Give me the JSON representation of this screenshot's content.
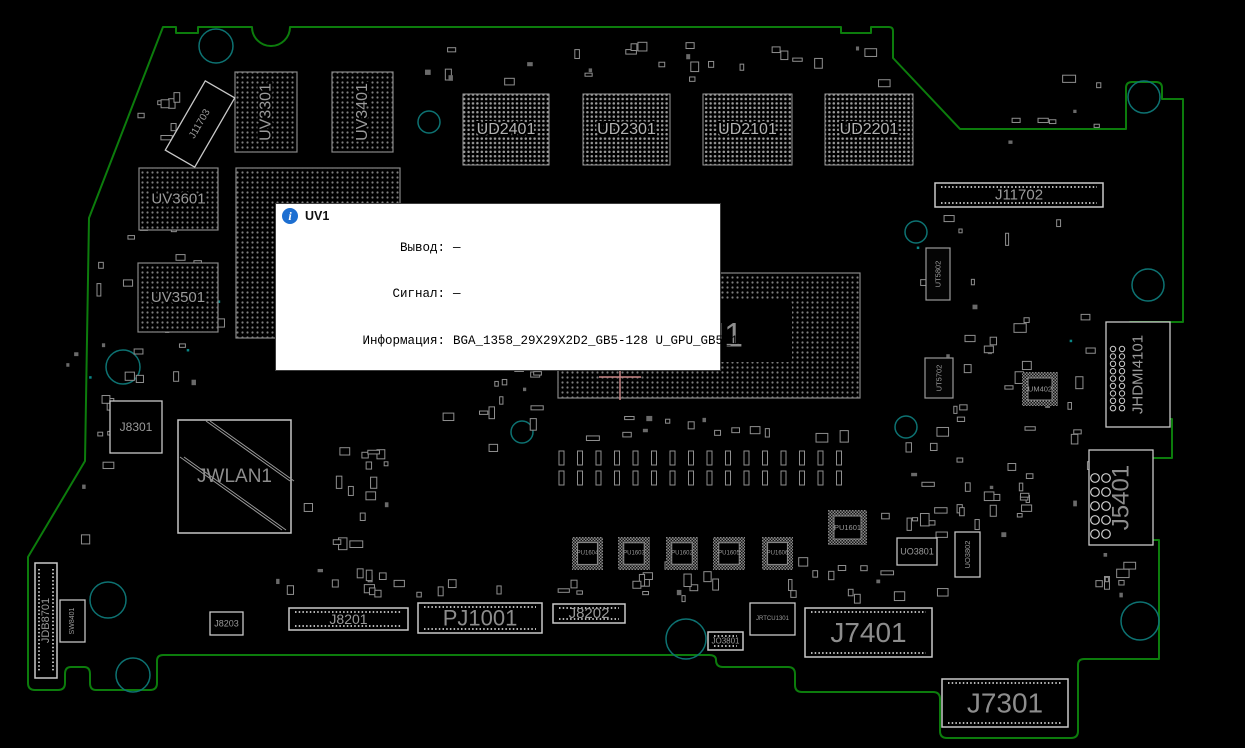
{
  "colors": {
    "background": "#000000",
    "outline": "#0c7c0c",
    "hole": "#0d7272",
    "component": "#9a9a9a",
    "connector": "#c9c9c9",
    "label": "#9a9a9a",
    "bga_label": "#b2b2b2",
    "big_label": "#8d8d8d",
    "crosshair": "#c98585",
    "via": "#0a8585",
    "info_icon": "#1d6fd1"
  },
  "tooltip": {
    "icon": "info-icon",
    "title": "UV1",
    "rows": [
      {
        "label": "Вывод:",
        "value": "—"
      },
      {
        "label": "Сигнал:",
        "value": "—"
      },
      {
        "label": "Информация:",
        "value": "BGA_1358_29X29X2D2_GB5-128 U_GPU_GB5_128"
      }
    ]
  },
  "board": {
    "holes": [
      {
        "cx": 216,
        "cy": 46,
        "r": 17
      },
      {
        "cx": 429,
        "cy": 122,
        "r": 11
      },
      {
        "cx": 916,
        "cy": 232,
        "r": 11
      },
      {
        "cx": 1144,
        "cy": 97,
        "r": 16
      },
      {
        "cx": 1148,
        "cy": 285,
        "r": 16
      },
      {
        "cx": 123,
        "cy": 367,
        "r": 17
      },
      {
        "cx": 522,
        "cy": 432,
        "r": 11
      },
      {
        "cx": 906,
        "cy": 427,
        "r": 11
      },
      {
        "cx": 108,
        "cy": 600,
        "r": 18
      },
      {
        "cx": 133,
        "cy": 675,
        "r": 17
      },
      {
        "cx": 686,
        "cy": 639,
        "r": 20
      },
      {
        "cx": 1140,
        "cy": 621,
        "r": 19
      }
    ],
    "components": [
      {
        "id": "uv3301",
        "label": "UV3301",
        "x": 235,
        "y": 72,
        "w": 62,
        "h": 80,
        "kind": "bga",
        "rot": -90,
        "fs": 16
      },
      {
        "id": "uv3401",
        "label": "UV3401",
        "x": 332,
        "y": 72,
        "w": 61,
        "h": 80,
        "kind": "bga",
        "rot": -90,
        "fs": 16
      },
      {
        "id": "ud2401",
        "label": "UD2401",
        "x": 463,
        "y": 94,
        "w": 86,
        "h": 71,
        "kind": "bga2",
        "fs": 16
      },
      {
        "id": "ud2301",
        "label": "UD2301",
        "x": 583,
        "y": 94,
        "w": 87,
        "h": 71,
        "kind": "bga2",
        "fs": 16
      },
      {
        "id": "ud2101",
        "label": "UD2101",
        "x": 703,
        "y": 94,
        "w": 89,
        "h": 71,
        "kind": "bga2",
        "fs": 16
      },
      {
        "id": "ud2201",
        "label": "UD2201",
        "x": 825,
        "y": 94,
        "w": 88,
        "h": 71,
        "kind": "bga2",
        "fs": 16
      },
      {
        "id": "uv3601",
        "label": "UV3601",
        "x": 139,
        "y": 168,
        "w": 79,
        "h": 62,
        "kind": "bga",
        "fs": 15
      },
      {
        "id": "uv3501",
        "label": "UV3501",
        "x": 138,
        "y": 263,
        "w": 80,
        "h": 69,
        "kind": "bga",
        "fs": 15
      },
      {
        "id": "uv1",
        "label": "",
        "x": 236,
        "y": 168,
        "w": 164,
        "h": 170,
        "kind": "bga"
      },
      {
        "id": "uu1",
        "label": "UU1",
        "x": 558,
        "y": 273,
        "w": 302,
        "h": 125,
        "kind": "bgaL",
        "fs": 34
      },
      {
        "id": "j11702",
        "label": "J11702",
        "x": 935,
        "y": 183,
        "w": 168,
        "h": 24,
        "kind": "conn",
        "fs": 15
      },
      {
        "id": "j11703",
        "label": "J11703",
        "x": 183,
        "y": 84,
        "w": 34,
        "h": 80,
        "kind": "connP",
        "grot": 30,
        "rot": -90,
        "fs": 10
      },
      {
        "id": "jhdmi4101",
        "label": "JHDMI4101",
        "x": 1106,
        "y": 322,
        "w": 64,
        "h": 105,
        "kind": "connP",
        "rot": -90,
        "fs": 15,
        "pins": "circles"
      },
      {
        "id": "j5401",
        "label": "J5401",
        "x": 1089,
        "y": 450,
        "w": 64,
        "h": 95,
        "kind": "connP",
        "rot": -90,
        "fs": 24,
        "pins": "circles"
      },
      {
        "id": "j8301",
        "label": "J8301",
        "x": 110,
        "y": 401,
        "w": 52,
        "h": 52,
        "kind": "connP",
        "fs": 12
      },
      {
        "id": "jwlan1",
        "label": "JWLAN1",
        "x": 178,
        "y": 420,
        "w": 113,
        "h": 113,
        "kind": "slot",
        "fs": 19
      },
      {
        "id": "jdb8701",
        "label": "JDB8701",
        "x": 35,
        "y": 563,
        "w": 22,
        "h": 115,
        "kind": "conn",
        "rot": -90,
        "fs": 11
      },
      {
        "id": "sw8401",
        "label": "SW8401",
        "x": 60,
        "y": 600,
        "w": 25,
        "h": 42,
        "kind": "chipL",
        "rot": -90,
        "fs": 7
      },
      {
        "id": "j8203",
        "label": "J8203",
        "x": 210,
        "y": 612,
        "w": 33,
        "h": 23,
        "kind": "connP",
        "fs": 9
      },
      {
        "id": "j8201",
        "label": "J8201",
        "x": 289,
        "y": 608,
        "w": 119,
        "h": 22,
        "kind": "conn",
        "fs": 14
      },
      {
        "id": "pj1001",
        "label": "PJ1001",
        "x": 418,
        "y": 603,
        "w": 124,
        "h": 30,
        "kind": "conn",
        "fs": 22
      },
      {
        "id": "j8202",
        "label": "J8202",
        "x": 553,
        "y": 604,
        "w": 72,
        "h": 19,
        "kind": "conn",
        "fs": 15
      },
      {
        "id": "jo3801",
        "label": "JO3801",
        "x": 708,
        "y": 632,
        "w": 35,
        "h": 18,
        "kind": "conn",
        "fs": 8
      },
      {
        "id": "jrtcu1301",
        "label": "JRTCU1301",
        "x": 750,
        "y": 603,
        "w": 45,
        "h": 32,
        "kind": "connP",
        "fs": 6
      },
      {
        "id": "j7401",
        "label": "J7401",
        "x": 805,
        "y": 608,
        "w": 127,
        "h": 49,
        "kind": "conn",
        "fs": 28
      },
      {
        "id": "j7301",
        "label": "J7301",
        "x": 942,
        "y": 679,
        "w": 126,
        "h": 48,
        "kind": "conn",
        "fs": 28
      },
      {
        "id": "ut5802",
        "label": "UT5802",
        "x": 926,
        "y": 248,
        "w": 24,
        "h": 52,
        "kind": "chip",
        "rot": -90,
        "fs": 7.5
      },
      {
        "id": "ut5702",
        "label": "UT5702",
        "x": 925,
        "y": 358,
        "w": 28,
        "h": 40,
        "kind": "chip",
        "rot": -90,
        "fs": 7.5
      },
      {
        "id": "um402",
        "label": "UM402",
        "x": 1022,
        "y": 372,
        "w": 36,
        "h": 34,
        "kind": "chipH",
        "fs": 7.5
      },
      {
        "id": "pu1601",
        "label": "PU1601",
        "x": 828,
        "y": 510,
        "w": 39,
        "h": 35,
        "kind": "chipH",
        "fs": 7.5
      },
      {
        "id": "pu1604",
        "label": "PU1604",
        "x": 572,
        "y": 537,
        "w": 31,
        "h": 33,
        "kind": "chipH",
        "fs": 6
      },
      {
        "id": "pu1603",
        "label": "PU1603",
        "x": 618,
        "y": 537,
        "w": 32,
        "h": 33,
        "kind": "chipH",
        "fs": 6
      },
      {
        "id": "pu1602",
        "label": "PU1602",
        "x": 666,
        "y": 537,
        "w": 32,
        "h": 33,
        "kind": "chipH",
        "fs": 6
      },
      {
        "id": "pu1605",
        "label": "PU1605",
        "x": 713,
        "y": 537,
        "w": 32,
        "h": 33,
        "kind": "chipH",
        "fs": 6
      },
      {
        "id": "pu1606",
        "label": "PU1606",
        "x": 762,
        "y": 537,
        "w": 31,
        "h": 33,
        "kind": "chipH",
        "fs": 6
      },
      {
        "id": "uo3801",
        "label": "UO3801",
        "x": 897,
        "y": 538,
        "w": 40,
        "h": 27,
        "kind": "chipL",
        "fs": 9
      },
      {
        "id": "uo3802",
        "label": "UO3802",
        "x": 955,
        "y": 532,
        "w": 25,
        "h": 45,
        "kind": "chipL",
        "rot": -90,
        "fs": 7.5
      }
    ],
    "crosshair": {
      "x": 620,
      "y": 377
    }
  }
}
